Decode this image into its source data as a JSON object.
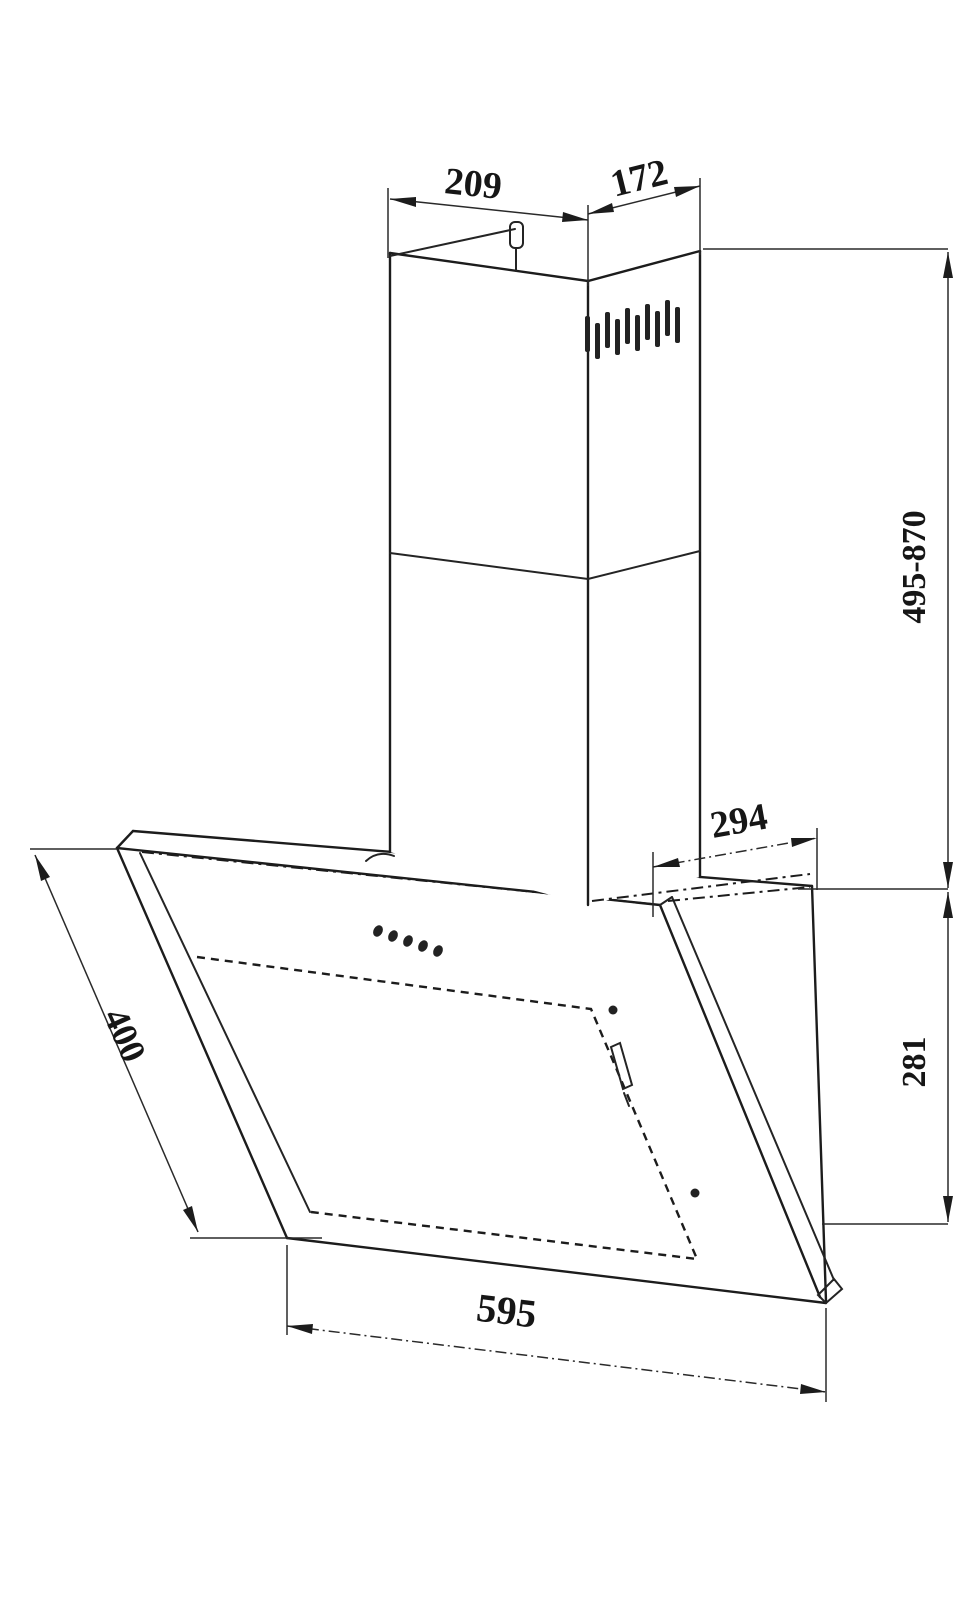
{
  "drawing": {
    "dimensions": {
      "chimney_top_width": "209",
      "chimney_top_depth": "172",
      "chimney_height_range": "495-870",
      "hood_top_depth": "294",
      "hood_body_height": "281",
      "glass_panel_length": "400",
      "hood_width": "595"
    },
    "features": {
      "vent_slot_count": 10,
      "control_button_count": 5
    },
    "colors": {
      "line": "#1c1c1c",
      "background": "#ffffff"
    }
  }
}
